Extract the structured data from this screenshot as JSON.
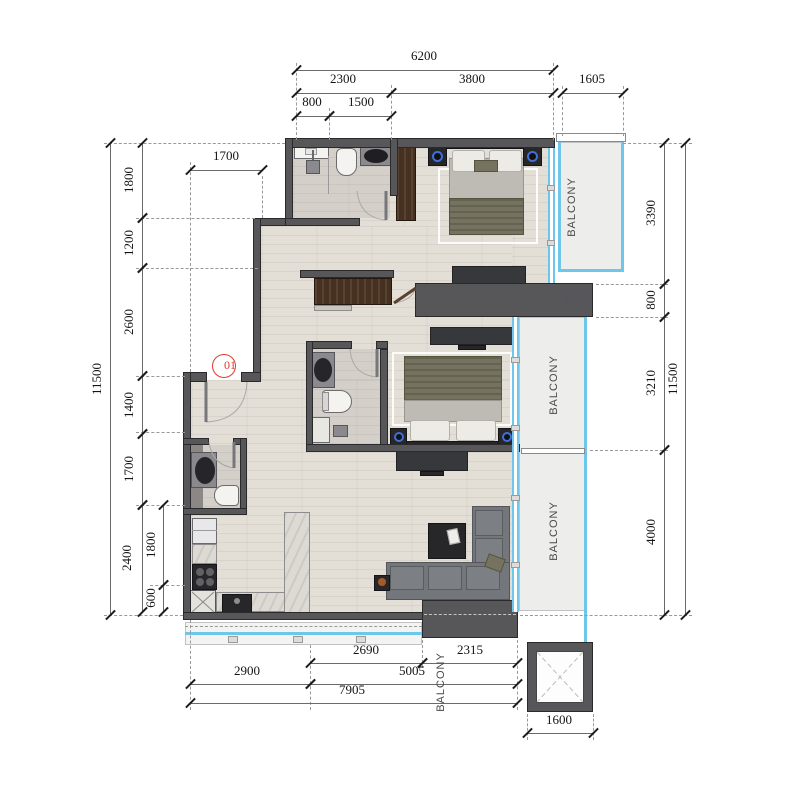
{
  "unit_marker": {
    "label": "01"
  },
  "colors": {
    "wall": "#57575a",
    "glass_cyan": "#6ec6ea",
    "marker_red": "#e03a2f",
    "balcony_fill": "#ededec"
  },
  "balcony_labels": [
    {
      "text": "BALCONY",
      "x": 572,
      "y": 207
    },
    {
      "text": "BALCONY",
      "x": 554,
      "y": 385
    },
    {
      "text": "BALCONY",
      "x": 554,
      "y": 531
    },
    {
      "text": "BALCONY",
      "x": 441,
      "y": 682
    }
  ],
  "dimensions": [
    {
      "text": "6200",
      "o": "h",
      "a": 296,
      "b": 553,
      "c": 70,
      "lx": 424,
      "ly": 56
    },
    {
      "text": "2300",
      "o": "h",
      "a": 296,
      "b": 391,
      "c": 93,
      "lx": 343,
      "ly": 79
    },
    {
      "text": "3800",
      "o": "h",
      "a": 391,
      "b": 553,
      "c": 93,
      "lx": 472,
      "ly": 79
    },
    {
      "text": "1605",
      "o": "h",
      "a": 562,
      "b": 623,
      "c": 93,
      "lx": 592,
      "ly": 79
    },
    {
      "text": "800",
      "o": "h",
      "a": 296,
      "b": 329,
      "c": 116,
      "lx": 312,
      "ly": 102
    },
    {
      "text": "1500",
      "o": "h",
      "a": 329,
      "b": 391,
      "c": 116,
      "lx": 361,
      "ly": 102
    },
    {
      "text": "1700",
      "o": "h",
      "a": 190,
      "b": 262,
      "c": 170,
      "lx": 226,
      "ly": 156
    },
    {
      "text": "11500",
      "o": "v",
      "a": 143,
      "b": 615,
      "c": 110,
      "lx": 97,
      "ly": 379
    },
    {
      "text": "1800",
      "o": "v",
      "a": 143,
      "b": 218,
      "c": 142,
      "lx": 129,
      "ly": 180
    },
    {
      "text": "1200",
      "o": "v",
      "a": 218,
      "b": 268,
      "c": 142,
      "lx": 129,
      "ly": 243
    },
    {
      "text": "2600",
      "o": "v",
      "a": 268,
      "b": 376,
      "c": 142,
      "lx": 129,
      "ly": 322
    },
    {
      "text": "1400",
      "o": "v",
      "a": 376,
      "b": 434,
      "c": 142,
      "lx": 129,
      "ly": 405
    },
    {
      "text": "1700",
      "o": "v",
      "a": 434,
      "b": 505,
      "c": 142,
      "lx": 129,
      "ly": 469
    },
    {
      "text": "2400",
      "o": "v",
      "a": 505,
      "b": 612,
      "c": 142,
      "lx": 127,
      "ly": 558
    },
    {
      "text": "1800",
      "o": "v",
      "a": 505,
      "b": 585,
      "c": 163,
      "lx": 151,
      "ly": 545
    },
    {
      "text": "600",
      "o": "v",
      "a": 585,
      "b": 612,
      "c": 163,
      "lx": 151,
      "ly": 598
    },
    {
      "text": "3390",
      "o": "v",
      "a": 143,
      "b": 284,
      "c": 664,
      "lx": 651,
      "ly": 213
    },
    {
      "text": "800",
      "o": "v",
      "a": 284,
      "b": 317,
      "c": 664,
      "lx": 651,
      "ly": 300
    },
    {
      "text": "3210",
      "o": "v",
      "a": 317,
      "b": 450,
      "c": 664,
      "lx": 651,
      "ly": 383
    },
    {
      "text": "4000",
      "o": "v",
      "a": 450,
      "b": 615,
      "c": 664,
      "lx": 651,
      "ly": 532
    },
    {
      "text": "11500",
      "o": "v",
      "a": 143,
      "b": 615,
      "c": 685,
      "lx": 673,
      "ly": 379
    },
    {
      "text": "2690",
      "o": "h",
      "a": 310,
      "b": 422,
      "c": 663,
      "lx": 366,
      "ly": 650
    },
    {
      "text": "2315",
      "o": "h",
      "a": 422,
      "b": 517,
      "c": 663,
      "lx": 470,
      "ly": 650
    },
    {
      "text": "2900",
      "o": "h",
      "a": 190,
      "b": 310,
      "c": 684,
      "lx": 247,
      "ly": 671
    },
    {
      "text": "5005",
      "o": "h",
      "a": 310,
      "b": 517,
      "c": 684,
      "lx": 412,
      "ly": 671
    },
    {
      "text": "7905",
      "o": "h",
      "a": 190,
      "b": 517,
      "c": 703,
      "lx": 352,
      "ly": 690
    },
    {
      "text": "1600",
      "o": "h",
      "a": 527,
      "b": 593,
      "c": 733,
      "lx": 559,
      "ly": 720
    }
  ]
}
